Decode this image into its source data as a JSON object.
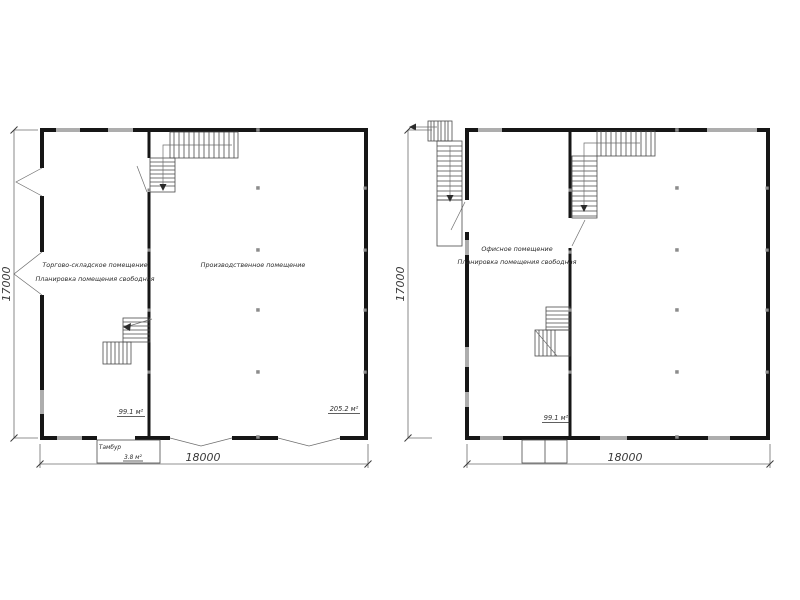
{
  "drawing_type": "floor-plans",
  "colors": {
    "wall": "#161616",
    "window": "#adadad",
    "dimension_line": "#6b6b6b",
    "text": "#2b2b2b",
    "background": "#ffffff"
  },
  "plan_left": {
    "room_trade": {
      "label_line1": "Торгово-складское помещение",
      "label_line2": "Планировка помещения свободная",
      "area": "99.1 м²"
    },
    "room_production": {
      "label": "Производственное помещение",
      "area": "205.2 м²"
    },
    "tambour": {
      "label": "Тамбур",
      "area": "3.8 м²"
    },
    "dim_width": "18000",
    "dim_height": "17000"
  },
  "plan_right": {
    "room_office": {
      "label_line1": "Офисное помещение",
      "label_line2": "Планировка помещения свободная",
      "area": "99.1 м²"
    },
    "dim_width": "18000",
    "dim_height": "17000"
  }
}
